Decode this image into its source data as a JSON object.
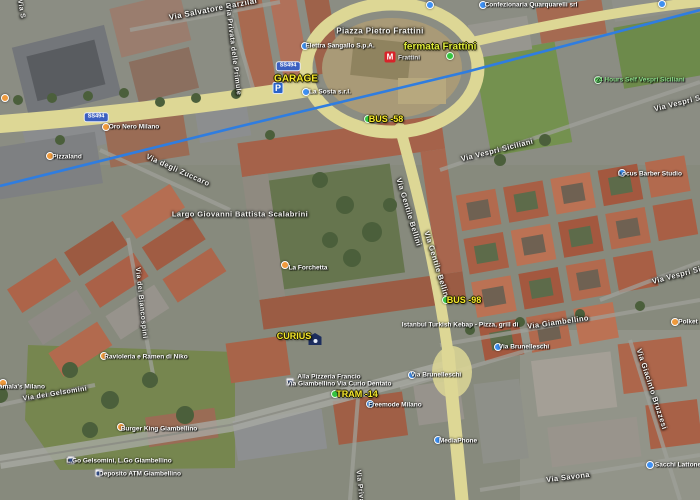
{
  "map": {
    "type": "satellite-map-screenshot",
    "colors": {
      "route_blue": "#2f7de0",
      "road_yellow": "#ddd795",
      "label_yellow": "#f5e62e",
      "fermata_yellow_green": "#dde93c",
      "open_green_label": "#8ce08c",
      "poi_orange": "#f09a3c",
      "poi_blue": "#3d8ff2",
      "transit_green": "#35c33f",
      "metro_red": "#d8232a",
      "parking_blue": "#2a63c9"
    },
    "glyphs": {
      "parking": "P",
      "metro": "M"
    },
    "shields": [
      {
        "t": "SS494",
        "x": 288,
        "y": 66
      },
      {
        "t": "SS494",
        "x": 96,
        "y": 117
      }
    ],
    "streets": [
      {
        "t": "Via Salvatore Barzilai",
        "x": 213,
        "y": 9,
        "r": -11,
        "s": 8
      },
      {
        "t": "Via S",
        "x": 21,
        "y": 9,
        "r": 80,
        "s": 7
      },
      {
        "t": "Via Privata delle Primule",
        "x": 233,
        "y": 50,
        "r": 83,
        "s": 7
      },
      {
        "t": "Piazza Pietro Frattini",
        "x": 380,
        "y": 31,
        "r": 0,
        "s": 8
      },
      {
        "t": "Via degli Zuccaro",
        "x": 178,
        "y": 170,
        "r": 24,
        "s": 7.5
      },
      {
        "t": "Largo Giovanni Battista Scalabrini",
        "x": 240,
        "y": 214,
        "r": 0,
        "s": 7.5
      },
      {
        "t": "Via Vespri Siciliani",
        "x": 497,
        "y": 150,
        "r": -14,
        "s": 7.5
      },
      {
        "t": "Via Vespri Siciliani",
        "x": 690,
        "y": 100,
        "r": -14,
        "s": 7.5
      },
      {
        "t": "Via Vespri Siciliani",
        "x": 688,
        "y": 272,
        "r": -15,
        "s": 7.5
      },
      {
        "t": "Via Gentile Bellini",
        "x": 409,
        "y": 212,
        "r": 73,
        "s": 7.5
      },
      {
        "t": "Via Gentile Bellini",
        "x": 437,
        "y": 265,
        "r": 73,
        "s": 7.5
      },
      {
        "t": "Via dei Biancospini",
        "x": 141,
        "y": 303,
        "r": 84,
        "s": 7
      },
      {
        "t": "Via Giambellino",
        "x": 558,
        "y": 322,
        "r": -8,
        "s": 7.5
      },
      {
        "t": "Via dei Gelsomini",
        "x": 55,
        "y": 394,
        "r": -9,
        "s": 7
      },
      {
        "t": "Via Giacinto Bruzzesi",
        "x": 652,
        "y": 389,
        "r": 72,
        "s": 7.5
      },
      {
        "t": "Via Savona",
        "x": 568,
        "y": 477,
        "r": -7,
        "s": 7.5
      },
      {
        "t": "Via Privata",
        "x": 360,
        "y": 490,
        "r": 84,
        "s": 7
      }
    ],
    "transit": [
      {
        "t": "GARAGE",
        "x": 296,
        "y": 79,
        "s": 10,
        "c": "#f5e62e",
        "icon": "parking",
        "ix": 278,
        "iy": 88
      },
      {
        "t": "fermata Frattini",
        "x": 440,
        "y": 47,
        "s": 10,
        "c": "#dde93c",
        "icon": "green-dot",
        "ix": 450,
        "iy": 56
      },
      {
        "t": "BUS -58",
        "x": 386,
        "y": 119,
        "s": 9,
        "c": "#f5e62e",
        "icon": "green-dot",
        "ix": 368,
        "iy": 119
      },
      {
        "t": "BUS -98",
        "x": 464,
        "y": 300,
        "s": 9,
        "c": "#f5e62e",
        "icon": "green-dot",
        "ix": 446,
        "iy": 300
      },
      {
        "t": "TRAM -14",
        "x": 357,
        "y": 394,
        "s": 9,
        "c": "#f5e62e",
        "icon": "green-dot",
        "ix": 335,
        "iy": 394
      },
      {
        "t": "CURIUS",
        "x": 294,
        "y": 336,
        "s": 9,
        "c": "#f5e62e",
        "icon": "house",
        "ix": 315,
        "iy": 339
      }
    ],
    "pois": [
      {
        "t": "Elettra Sangallo S.p.A.",
        "x": 340,
        "y": 46,
        "icon": "blue",
        "ix": 305,
        "iy": 46
      },
      {
        "t": "La Sosta s.r.l.",
        "x": 330,
        "y": 92,
        "icon": "blue",
        "ix": 306,
        "iy": 92
      },
      {
        "t": "Frattini",
        "x": 409,
        "y": 58,
        "icon": "metro",
        "ix": 390,
        "iy": 57,
        "c": "#e8e8e8"
      },
      {
        "t": "Oro Nero Milano",
        "x": 134,
        "y": 127,
        "icon": "orange",
        "ix": 106,
        "iy": 127
      },
      {
        "t": "Pizzaland",
        "x": 67,
        "y": 157,
        "icon": "orange",
        "ix": 50,
        "iy": 156
      },
      {
        "t": "",
        "x": 5,
        "y": 98,
        "icon": "orange",
        "ix": 5,
        "iy": 98
      },
      {
        "t": "",
        "x": 430,
        "y": 5,
        "icon": "blue",
        "ix": 430,
        "iy": 5
      },
      {
        "t": "",
        "x": 662,
        "y": 4,
        "icon": "blue",
        "ix": 662,
        "iy": 4
      },
      {
        "t": "Confezionaria Quarquarelli srl",
        "x": 531,
        "y": 5,
        "icon": "blue",
        "ix": 483,
        "iy": 5
      },
      {
        "t": "24 Hours Self Vespri Siciliani",
        "x": 640,
        "y": 80,
        "icon": "green",
        "ix": 598,
        "iy": 80,
        "c": "#8ce08c"
      },
      {
        "t": "Locus Barber Studio",
        "x": 650,
        "y": 174,
        "icon": "blue",
        "ix": 622,
        "iy": 173
      },
      {
        "t": "La Forchetta",
        "x": 308,
        "y": 268,
        "icon": "orange",
        "ix": 285,
        "iy": 265
      },
      {
        "t": "Istanbul Turkish Kebap - Pizza, grill di",
        "x": 460,
        "y": 325,
        "icon": null
      },
      {
        "t": "Polket",
        "x": 688,
        "y": 322,
        "icon": "orange",
        "ix": 675,
        "iy": 322
      },
      {
        "t": "Alla Pizzeria Francio",
        "x": 329,
        "y": 377,
        "icon": null
      },
      {
        "t": "Via Giambellino Via Curio Dentato",
        "x": 339,
        "y": 384,
        "icon": "whitebus",
        "ix": 290,
        "iy": 382
      },
      {
        "t": "Via Brunelleschi",
        "x": 436,
        "y": 375,
        "icon": "blue",
        "ix": 412,
        "iy": 375
      },
      {
        "t": "Via Brunelleschi",
        "x": 524,
        "y": 347,
        "icon": "blue",
        "ix": 498,
        "iy": 347
      },
      {
        "t": "Freemode Milano",
        "x": 395,
        "y": 405,
        "icon": "blue",
        "ix": 370,
        "iy": 404
      },
      {
        "t": "MediaPhone",
        "x": 458,
        "y": 441,
        "icon": "blue",
        "ix": 438,
        "iy": 440
      },
      {
        "t": "Sacchi Lattoneria",
        "x": 682,
        "y": 465,
        "icon": "blue",
        "ix": 650,
        "iy": 465
      },
      {
        "t": "Burger King Giambellino",
        "x": 159,
        "y": 429,
        "icon": "orange",
        "ix": 121,
        "iy": 427
      },
      {
        "t": "Ravioleria e Ramen di Niko",
        "x": 146,
        "y": 357,
        "icon": "orange",
        "ix": 104,
        "iy": 356
      },
      {
        "t": "amala's Milano",
        "x": 22,
        "y": 387,
        "icon": "orange",
        "ix": 3,
        "iy": 383
      },
      {
        "t": "L.Go Gelsomini, L.Go Giambellino",
        "x": 119,
        "y": 461,
        "icon": "whitebus",
        "ix": 71,
        "iy": 460
      },
      {
        "t": "Deposito ATM Giambellino",
        "x": 140,
        "y": 474,
        "icon": "whitebus",
        "ix": 99,
        "iy": 473
      }
    ]
  }
}
